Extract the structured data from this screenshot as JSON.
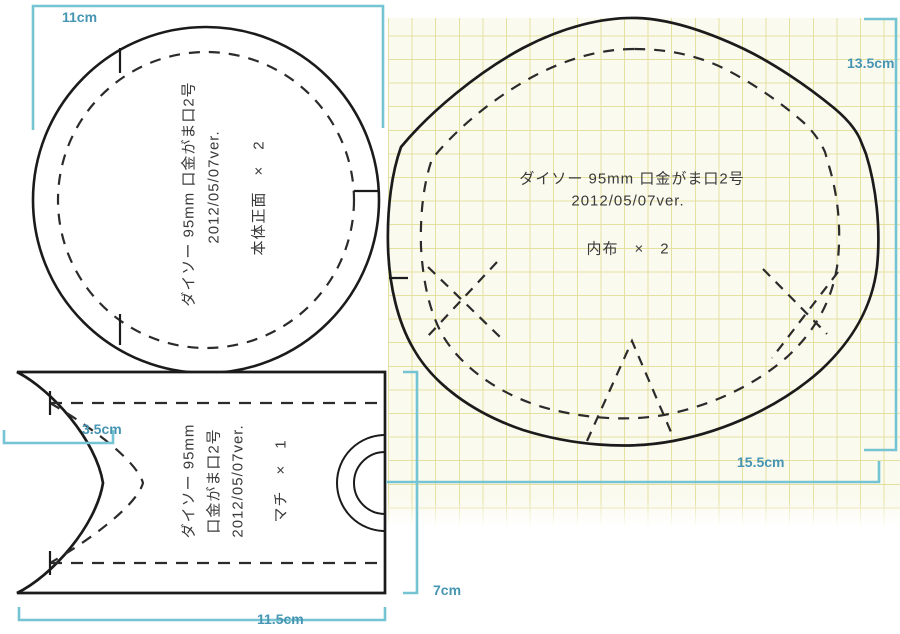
{
  "pieces": {
    "front": {
      "line1": "ダイソー 95mm 口金がま口2号",
      "line2": "2012/05/07ver.",
      "line3": "本体正面　×　2"
    },
    "lining": {
      "line1": "ダイソー 95mm 口金がま口2号",
      "line2": "2012/05/07ver.",
      "line3": "内布　×　2"
    },
    "gusset": {
      "line1": "ダイソー 95mm",
      "line2": "口金がま口2号",
      "line3": "2012/05/07ver.",
      "line4": "マチ　×　1"
    }
  },
  "dimensions": {
    "front_width": "11cm",
    "lining_height": "13.5cm",
    "lining_width": "15.5cm",
    "gusset_notch": "3.5cm",
    "gusset_height": "7cm",
    "gusset_width": "11.5cm"
  },
  "colors": {
    "outline": "#1b1b1b",
    "dimension_line": "#74c4d3",
    "dimension_text": "#4695b2",
    "grid_line": "#e4e1a0",
    "grid_background": "#fbfaef"
  }
}
